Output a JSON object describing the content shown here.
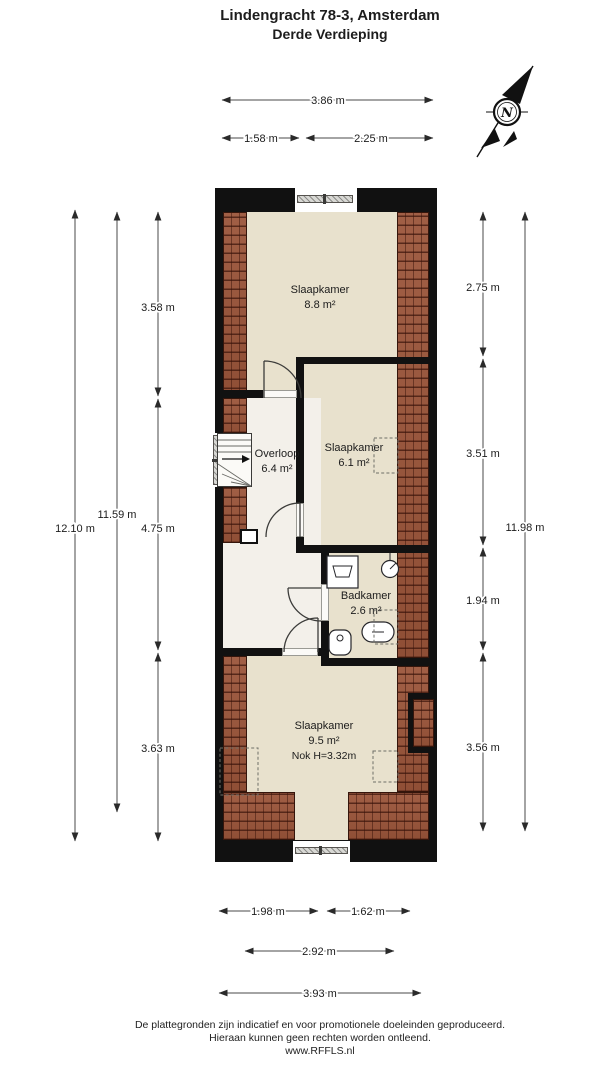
{
  "title": {
    "line1": "Lindengracht 78-3, Amsterdam",
    "line2": "Derde Verdieping"
  },
  "compass": {
    "label": "N"
  },
  "rooms": [
    {
      "name": "Slaapkamer",
      "area": "8.8 m²"
    },
    {
      "name": "Overloop",
      "area": "6.4 m²"
    },
    {
      "name": "Slaapkamer",
      "area": "6.1 m²"
    },
    {
      "name": "Badkamer",
      "area": "2.6 m²"
    },
    {
      "name": "Slaapkamer",
      "area": "9.5 m²",
      "note": "Nok H=3.32m"
    }
  ],
  "dimensions": {
    "top": [
      "3.86 m",
      "1.58 m",
      "2.25 m"
    ],
    "left": [
      "12.10 m",
      "11.59 m",
      "3.58 m",
      "4.75 m",
      "3.63 m"
    ],
    "right": [
      "2.75 m",
      "3.51 m",
      "1.94 m",
      "3.56 m",
      "11.98 m"
    ],
    "bottom": [
      "1.98 m",
      "1.62 m",
      "2.92 m",
      "3.93 m"
    ]
  },
  "footer": {
    "line1": "De plattegronden zijn indicatief en voor promotionele doeleinden geproduceerd.",
    "line2": "Hieraan kunnen geen rechten worden ontleend.",
    "line3": "www.RFFLS.nl"
  },
  "colors": {
    "wall": "#111111",
    "beige": "#e8e1cd",
    "whitefloor": "#f3f0ea",
    "brick": "#9b553a"
  }
}
